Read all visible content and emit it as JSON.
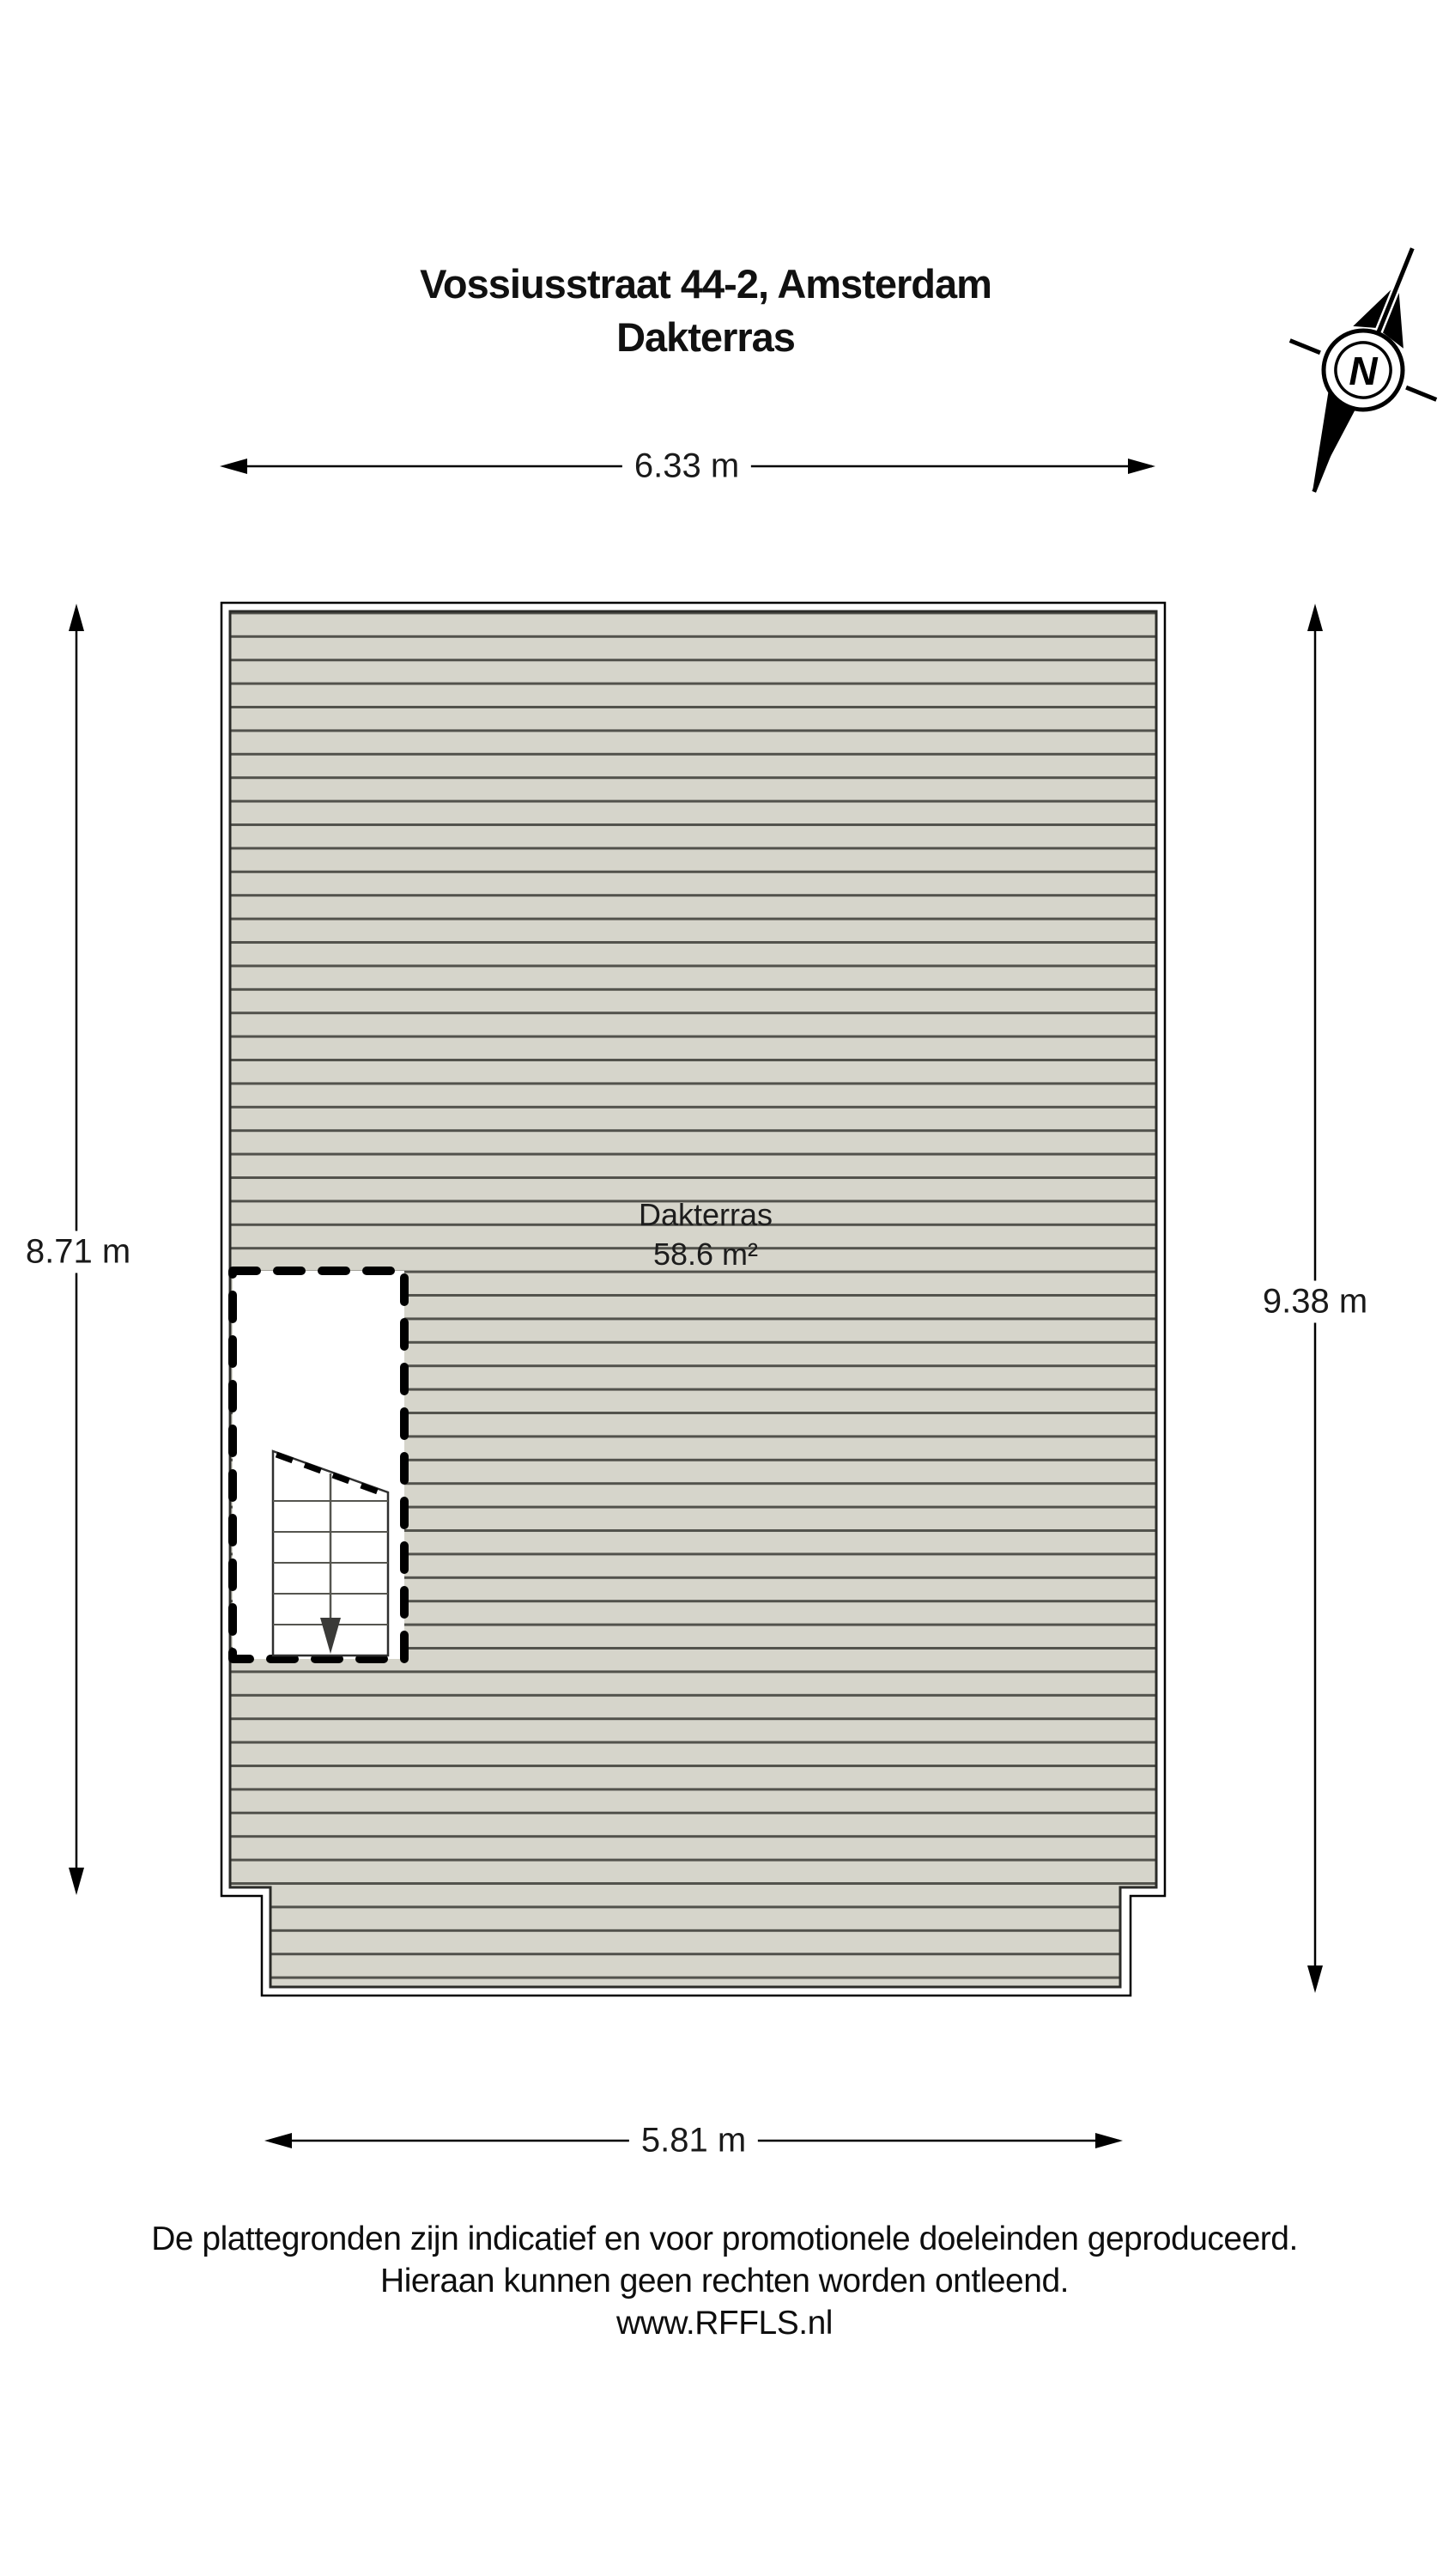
{
  "title": {
    "line1": "Vossiusstraat 44-2, Amsterdam",
    "line2": "Dakterras"
  },
  "compass": {
    "label": "N"
  },
  "room": {
    "name": "Dakterras",
    "area": "58.6 m²"
  },
  "dimensions": {
    "top": "6.33 m",
    "bottom": "5.81 m",
    "left": "8.71 m",
    "right": "9.38 m"
  },
  "footer": {
    "line1": "De plattegronden zijn indicatief en voor promotionele doeleinden geproduceerd.",
    "line2": "Hieraan kunnen geen rechten worden ontleend.",
    "line3": "www.RFFLS.nl"
  },
  "colors": {
    "deck_fill": "#d6d5cb",
    "deck_stripe": "#52524c",
    "wall_line": "#000000"
  }
}
